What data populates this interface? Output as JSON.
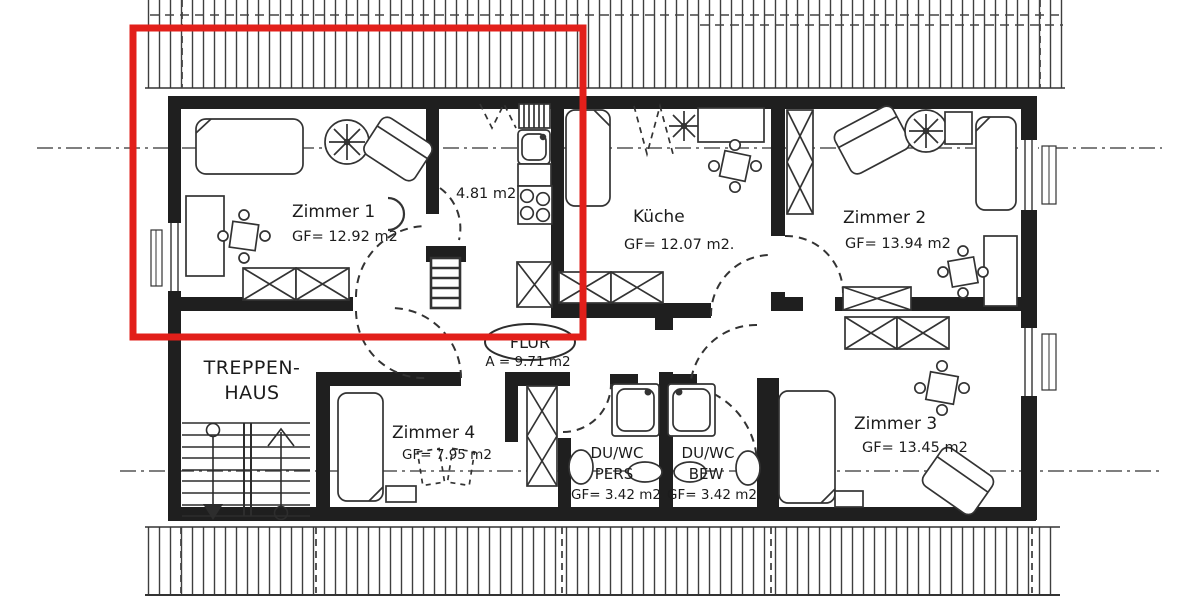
{
  "highlight": {
    "color": "#e21f1a"
  },
  "rooms": {
    "zimmer1": {
      "name": "Zimmer 1",
      "area": "GF= 12.92 m2"
    },
    "kitchenette": {
      "area": "4.81 m2"
    },
    "kueche": {
      "name": "Küche",
      "area": "GF= 12.07 m2."
    },
    "zimmer2": {
      "name": "Zimmer 2",
      "area": "GF= 13.94 m2"
    },
    "flur": {
      "name": "FLUR",
      "area": "A = 9.71 m2"
    },
    "treppenhaus": {
      "line1": "TREPPEN-",
      "line2": "HAUS"
    },
    "zimmer4": {
      "name": "Zimmer 4",
      "area": "GF= 7.95 m2"
    },
    "duwc_pers": {
      "line1": "DU/WC",
      "line2": "PERS",
      "area": "GF= 3.42 m2"
    },
    "duwc_bew": {
      "line1": "DU/WC",
      "line2": "BEW",
      "area": "GF= 3.42 m2"
    },
    "zimmer3": {
      "name": "Zimmer 3",
      "area": "GF= 13.45 m2"
    }
  }
}
